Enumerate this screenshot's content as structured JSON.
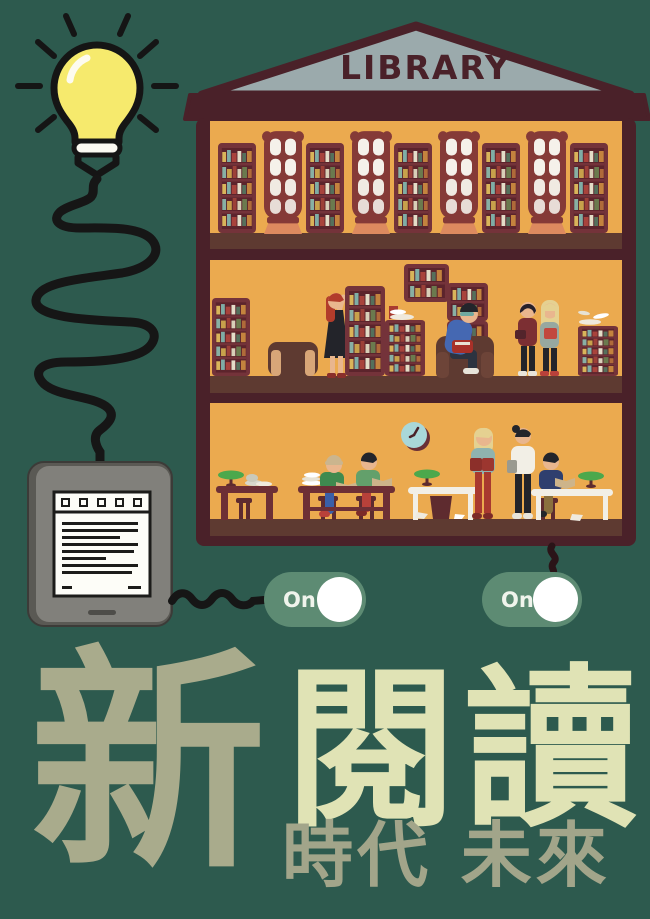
{
  "colors": {
    "background": "#2d5a4e",
    "switch_green": "#5d8b73",
    "building_frame": "#4a2129",
    "building_wall": "#ebaa4f",
    "roof_gray": "#9baaac",
    "floor_brown": "#5e3a31",
    "bulb_yellow": "#f6ea6d",
    "title_muted": "#a9ab8c",
    "title_bright": "#e0e3b5",
    "subtitle_muted": "#a2a58a"
  },
  "building": {
    "sign": "LIBRARY"
  },
  "switches": [
    {
      "label": "On",
      "state": "on"
    },
    {
      "label": "On",
      "state": "on"
    }
  ],
  "title": {
    "first": "新",
    "rest": "閱讀",
    "subtitle": "時代 未來"
  },
  "scene": {
    "icons": [
      "lightbulb-icon",
      "power-cable",
      "ereader-device",
      "toggle-switch",
      "wall-clock-icon",
      "bookshelf",
      "arched-window",
      "reading-lamp-icon",
      "armchair",
      "reading-table"
    ]
  }
}
